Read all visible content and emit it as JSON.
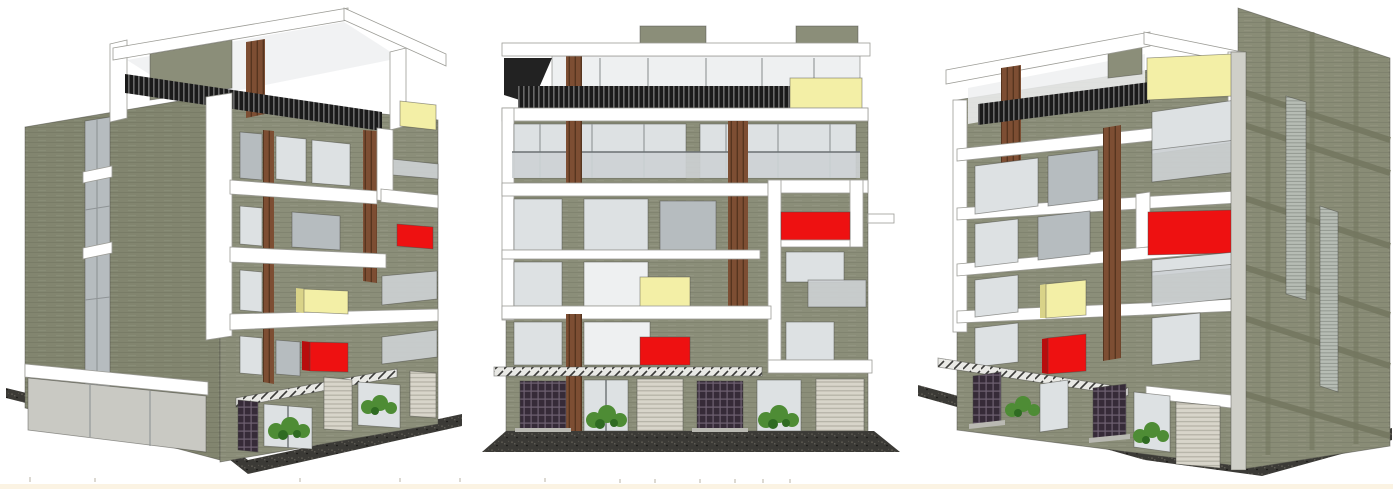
{
  "scene": {
    "subject": "three-view 3D architectural render of a five-storey residential building with roof terrace and ground-floor shops",
    "background": "#ffffff",
    "base_strip_color": "#fbf3e3",
    "views": [
      {
        "id": "left-perspective",
        "label": "left corner perspective"
      },
      {
        "id": "front-elevation",
        "label": "front elevation"
      },
      {
        "id": "right-perspective",
        "label": "right corner perspective"
      }
    ]
  },
  "colors": {
    "wall": "#8b8e79",
    "wallSide": "#82856f",
    "wallSideRight": "#898c76",
    "wallBand": "#73765f",
    "ribbon": "#ffffff",
    "outline": "#4a4a46",
    "roof": "#b9bab4",
    "louver": "#1a1a1a",
    "wood": "#7d4e33",
    "glass": "#dde1e3",
    "glassLight": "#eef0f1",
    "glassDark": "#b6bcbf",
    "rail": "#cdd2d4",
    "frame": "#8f9496",
    "accentRed": "#ee1111",
    "accentRedDark": "#b80d0d",
    "accentYellow": "#f3efa6",
    "accentYellowDark": "#d9d388",
    "ground": "#3b3a36",
    "plant": "#4e8c35",
    "plantDark": "#2f6b22",
    "door": "#362b38",
    "shutter": "#d8d5ca",
    "corner": "#cfcfc8",
    "step": "#b9b9b2",
    "baseStrip": "#fbf3e3"
  },
  "building": {
    "storeys_visible": 5,
    "roof_terrace": true,
    "ground_floor_features": [
      "lattice entrance doors",
      "glass shopfronts with planters",
      "roller shutters",
      "thin projecting canopy"
    ],
    "facade_features": [
      "white wrapping ribbon bands",
      "dark louver screen at terrace",
      "timber columns and slats",
      "red accent balcony panels",
      "pale yellow accent balcony panels",
      "glass balcony railings"
    ]
  }
}
